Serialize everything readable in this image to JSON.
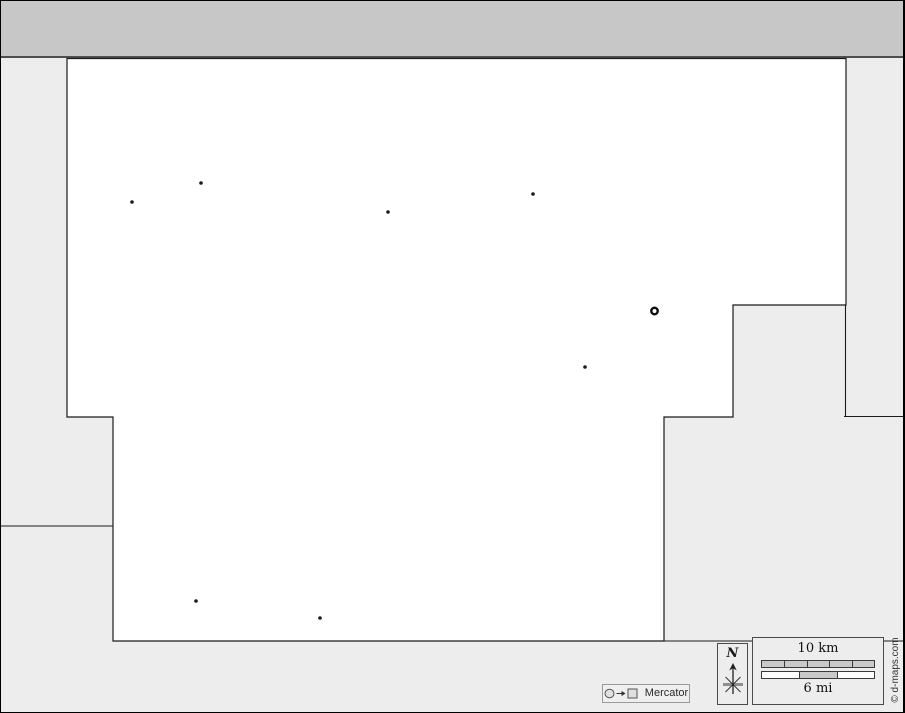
{
  "compass": {
    "north_label": "N"
  },
  "scale": {
    "km_label": "10 km",
    "mi_label": "6 mi",
    "km_segments": 5,
    "mi_segments": 3,
    "mi_filled_segment_index": 1
  },
  "projection": {
    "label": "Mercator"
  },
  "credit": {
    "text": "© d-maps.com"
  },
  "colors": {
    "topbar": "#c7c7c7",
    "outside_area": "#ededed",
    "map_fill": "#ffffff",
    "outline": "#1a1a1a",
    "scalebar_fill": "#c9c9c9"
  },
  "map": {
    "outline": [
      [
        66,
        57.5
      ],
      [
        845,
        57.5
      ],
      [
        845,
        304
      ],
      [
        732,
        304
      ],
      [
        732,
        416
      ],
      [
        663,
        416
      ],
      [
        663,
        640
      ],
      [
        112,
        640
      ],
      [
        112,
        416
      ],
      [
        66,
        416
      ]
    ],
    "boundary_lines": [
      [
        844.5,
        304,
        844.5,
        415.5
      ],
      [
        843,
        415.5,
        905,
        415.5
      ],
      [
        0,
        525,
        112,
        525
      ],
      [
        663,
        640,
        905,
        640
      ]
    ],
    "markers": [
      {
        "x": 131,
        "y": 201,
        "kind": "town"
      },
      {
        "x": 200,
        "y": 182,
        "kind": "town"
      },
      {
        "x": 387,
        "y": 211,
        "kind": "town"
      },
      {
        "x": 532,
        "y": 193,
        "kind": "town"
      },
      {
        "x": 584,
        "y": 366,
        "kind": "town"
      },
      {
        "x": 195,
        "y": 600,
        "kind": "town"
      },
      {
        "x": 319,
        "y": 617,
        "kind": "town"
      },
      {
        "x": 653.5,
        "y": 310,
        "kind": "capital"
      }
    ]
  }
}
